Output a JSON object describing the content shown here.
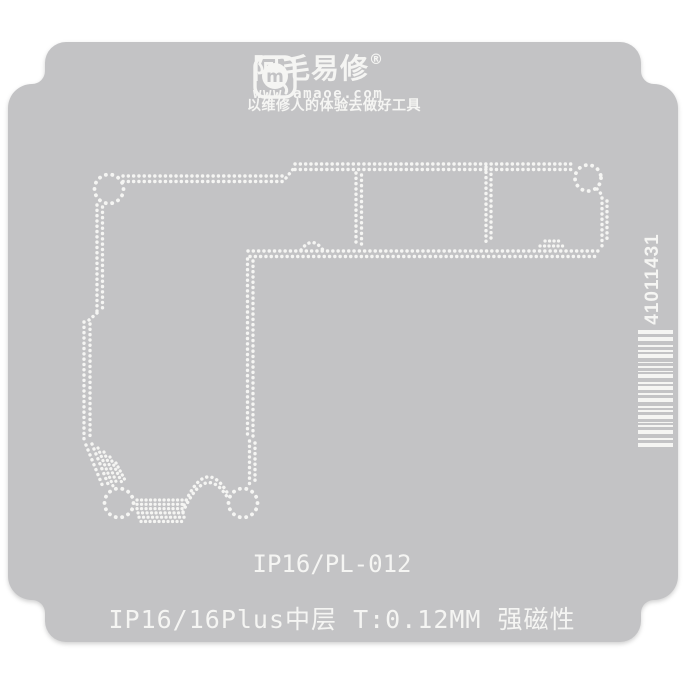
{
  "colors": {
    "background": "#ffffff",
    "plate": "#c3c3c5",
    "engraving": "#f5f5f3"
  },
  "logo": {
    "icon": "amaoe-m-logo",
    "monogram": "m",
    "brand": "阿毛易修",
    "registered": "®",
    "website": "www.amaoe.com",
    "tagline": "以维修人的体验去做好工具"
  },
  "engravings": {
    "model": "IP16/PL-012",
    "spec": "IP16/16Plus中层 T:0.12MM 强磁性"
  },
  "barcode": {
    "number": "41011431",
    "bars": [
      [
        4,
        3
      ],
      [
        4,
        4
      ],
      [
        2,
        3
      ],
      [
        2,
        2
      ],
      [
        4,
        4
      ],
      [
        1,
        3
      ],
      [
        2,
        3
      ],
      [
        1,
        2
      ],
      [
        4,
        4
      ],
      [
        2,
        2
      ],
      [
        4,
        3
      ],
      [
        2,
        3
      ],
      [
        4,
        4
      ],
      [
        2,
        2
      ],
      [
        2,
        3
      ],
      [
        4,
        3
      ],
      [
        1,
        2
      ],
      [
        2,
        3
      ],
      [
        4,
        4
      ],
      [
        2,
        3
      ],
      [
        4,
        0
      ]
    ]
  }
}
